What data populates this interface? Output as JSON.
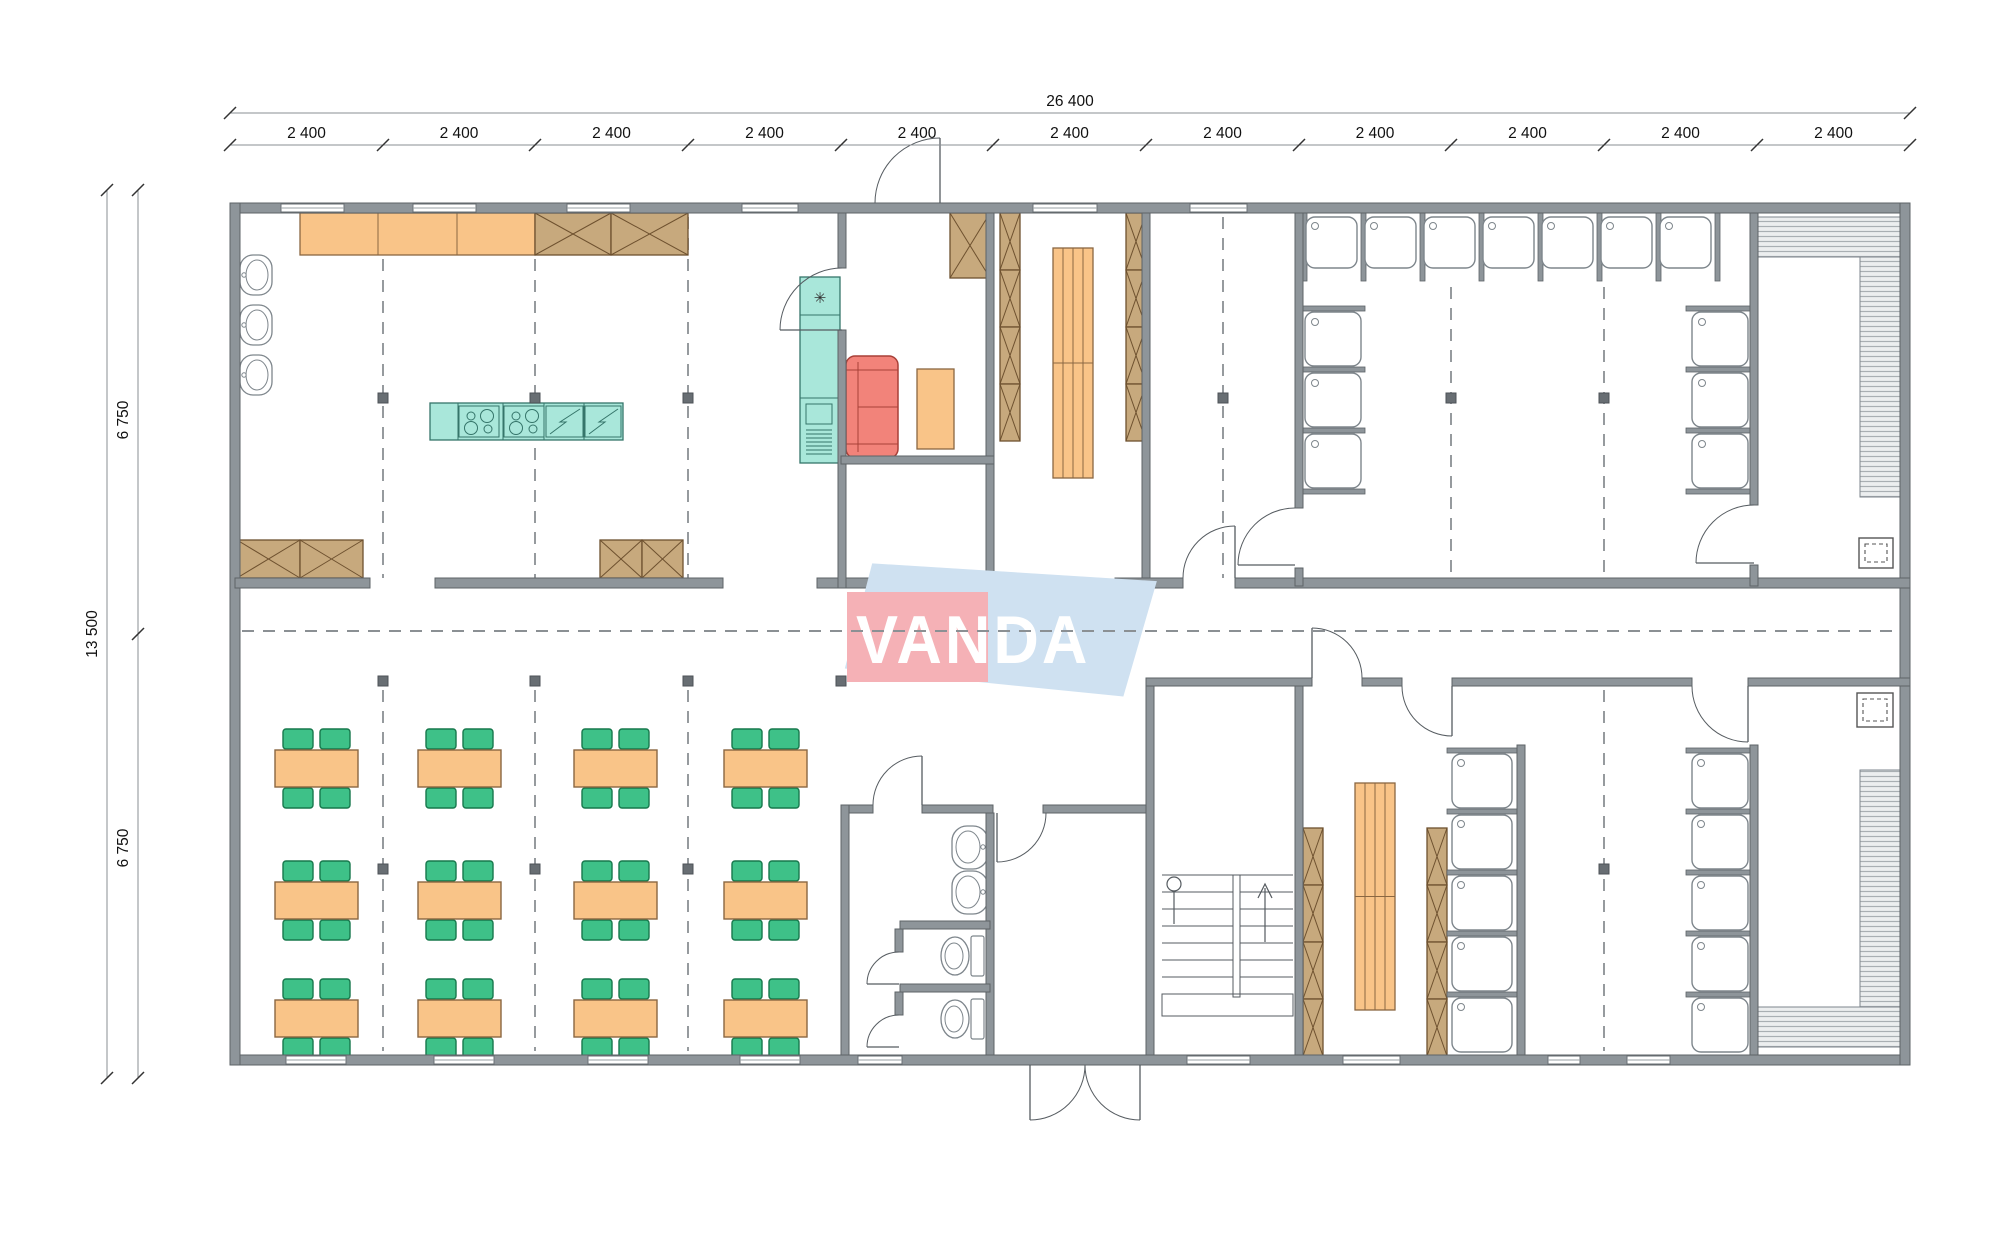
{
  "watermark": {
    "text": "VANDA",
    "red_color": "#f5b1b6",
    "blue_color": "#cfe1f1",
    "text_color": "#ffffff"
  },
  "dimensions": {
    "top_total_label": "26 400",
    "top_segment_label": "2 400",
    "top_segment_count": 11,
    "left_total_label": "13 500",
    "left_segment_labels": [
      "6 750",
      "6 750"
    ]
  },
  "symbols": {
    "freezer_star": "✳"
  },
  "colors": {
    "floor": "#ffffff",
    "wall": "#8e959a",
    "wall_edge": "#5d6367",
    "partition": "#9aa1a6",
    "wood_light": "#f9c488",
    "wood_edge": "#8a6742",
    "cabinet": "#c7a97d",
    "cabinet_edge": "#6e512f",
    "teal": "#a9e7da",
    "teal_edge": "#35756a",
    "sofa": "#f2837a",
    "sofa_edge": "#a84038",
    "chair": "#3ec188",
    "chair_edge": "#17784c",
    "bench_fill": "#eceeef",
    "bench_line": "#a9afb3",
    "fixture_line": "#7e868c",
    "door_line": "#565c61",
    "stair_line": "#555b60",
    "dash": "#8b9094",
    "column": "#686e73",
    "dim_line": "#8a8f93",
    "dim_text": "#111111"
  },
  "inventory": {
    "dining": {
      "tables": 12,
      "rows": 3,
      "cols": 4,
      "chairs_per_table": 4
    },
    "kitchen": {
      "wall_sinks": 3,
      "counter_sections": 3,
      "cooktops": 2,
      "dishwashers": 2,
      "refrigerators": 1
    },
    "lounge": {
      "sofas": 1,
      "side_tables": 1,
      "cabinets": 1
    },
    "shower_room_top": {
      "stalls_top_row": 7,
      "stalls_left_column": 3,
      "stalls_right_column": 3
    },
    "shower_columns_bottom": {
      "room_a_stalls": 5,
      "room_b_stalls": 5
    },
    "locker_rooms": {
      "wardrobe_columns": 6,
      "slat_benches": 2
    },
    "wc": {
      "toilets": 2,
      "sinks": 2
    },
    "saunas": {
      "count": 2,
      "heaters": 2,
      "bench_runs": 4
    },
    "staircases": 1,
    "entrance_double_doors": 1
  }
}
